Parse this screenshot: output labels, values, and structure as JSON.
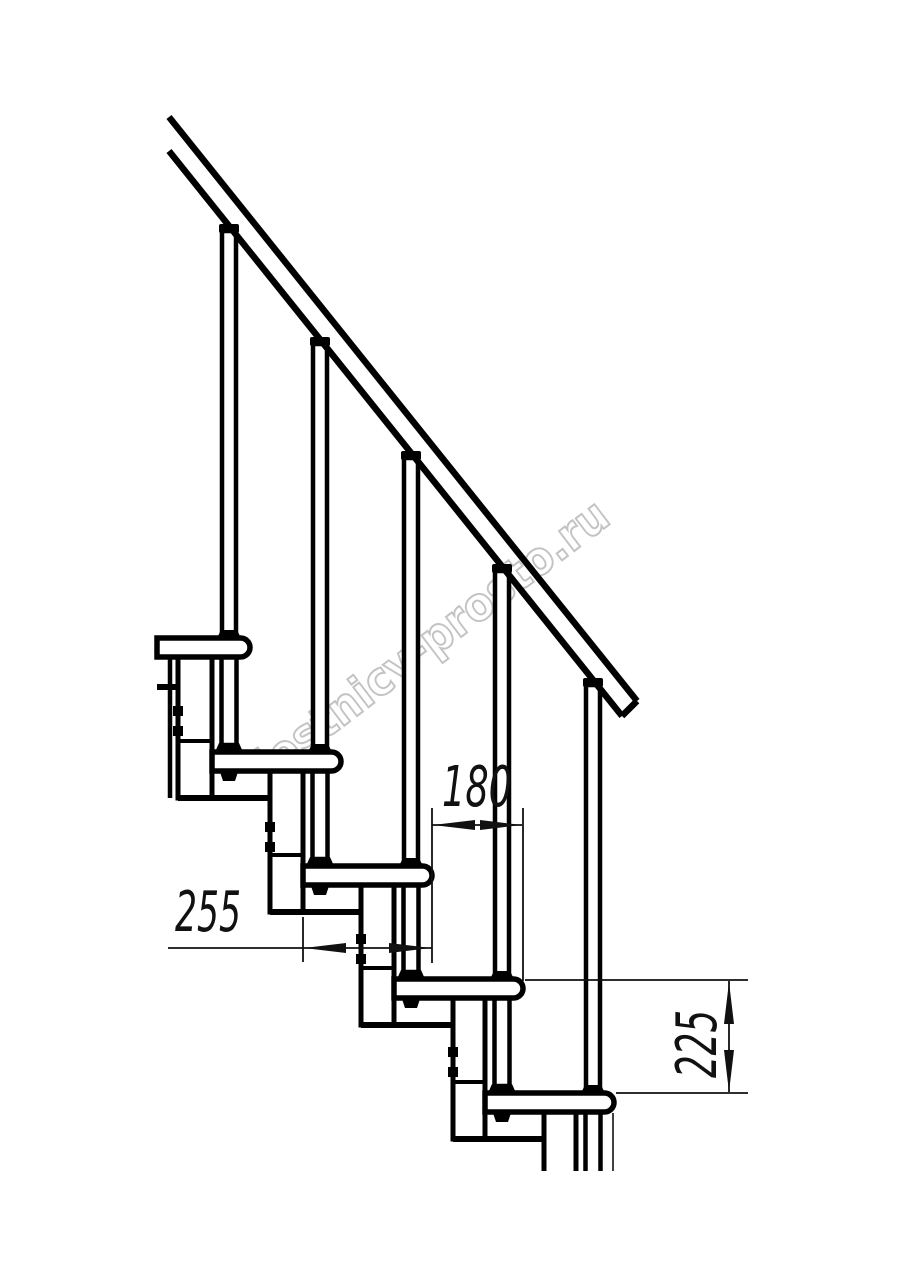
{
  "drawing": {
    "type": "modular staircase side-view technical drawing",
    "watermark": "lestnicy-prosto.ru",
    "treads_count": 5,
    "balusters_count": 5,
    "colors": {
      "line": "#000000",
      "dimension": "#111111",
      "watermark_outline": "#c3c3c3",
      "background": "#ffffff"
    },
    "dimensions": {
      "tread_depth_mm": "255",
      "step_run_mm": "180",
      "step_rise_mm": "225"
    }
  }
}
